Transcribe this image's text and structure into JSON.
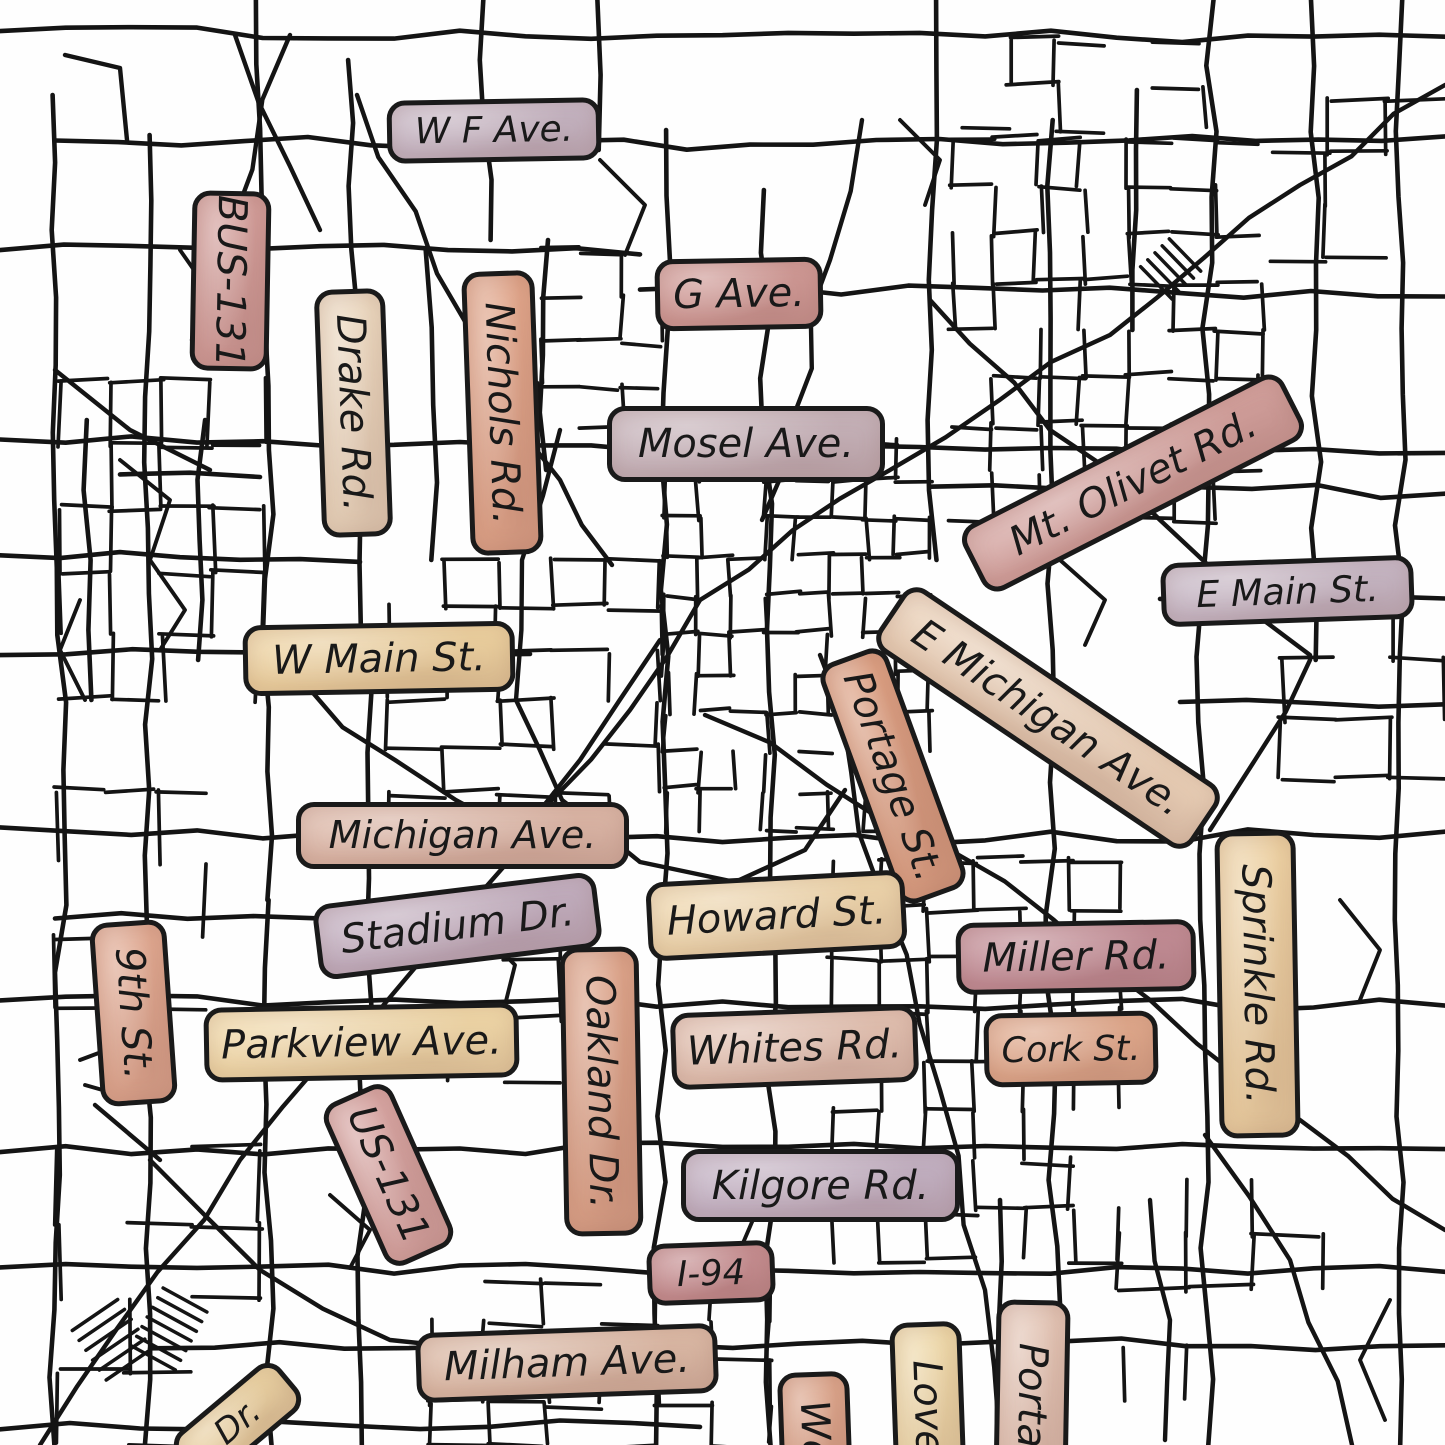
{
  "canvas": {
    "width": 1445,
    "height": 1445,
    "background_color": "#ffffff",
    "road_color": "#141414"
  },
  "map": {
    "description": "Hand-drawn style city street map with watercolor street-name badges",
    "labels": [
      {
        "id": "wf-ave",
        "text": "W F Ave.",
        "x": 387,
        "y": 99,
        "w": 214,
        "h": 63,
        "rotate": -1,
        "orientation": "horizontal",
        "fill": "#c6b6c4"
      },
      {
        "id": "bus-131",
        "text": "BUS-131",
        "x": 191,
        "y": 191,
        "w": 79,
        "h": 180,
        "rotate": 1,
        "orientation": "vertical",
        "fill": "#d19c98"
      },
      {
        "id": "drake-rd",
        "text": "Drake Rd.",
        "x": 318,
        "y": 289,
        "w": 71,
        "h": 248,
        "rotate": -2,
        "orientation": "vertical",
        "fill": "#ead6bd"
      },
      {
        "id": "nichols-rd",
        "text": "Nichols Rd.",
        "x": 466,
        "y": 271,
        "w": 73,
        "h": 284,
        "rotate": -2,
        "orientation": "vertical",
        "fill": "#dfa489"
      },
      {
        "id": "g-ave",
        "text": "G Ave.",
        "x": 655,
        "y": 258,
        "w": 168,
        "h": 72,
        "rotate": -1,
        "orientation": "horizontal",
        "fill": "#d09a96"
      },
      {
        "id": "mosel-ave",
        "text": "Mosel Ave.",
        "x": 607,
        "y": 406,
        "w": 278,
        "h": 76,
        "rotate": 0,
        "orientation": "horizontal",
        "fill": "#c6b3ba"
      },
      {
        "id": "mt-olivet-rd",
        "text": "Mt. Olivet Rd.",
        "x": 953,
        "y": 446,
        "w": 360,
        "h": 74,
        "rotate": -27,
        "orientation": "horizontal",
        "fill": "#d2a09c"
      },
      {
        "id": "e-main-st",
        "text": "E Main St.",
        "x": 1161,
        "y": 559,
        "w": 253,
        "h": 64,
        "rotate": -2,
        "orientation": "horizontal",
        "fill": "#c7b8c6"
      },
      {
        "id": "e-michigan-ave",
        "text": "E Michigan Ave.",
        "x": 858,
        "y": 680,
        "w": 380,
        "h": 76,
        "rotate": 34,
        "orientation": "horizontal",
        "fill": "#e9cfb6"
      },
      {
        "id": "portage-st",
        "text": "Portage St.",
        "x": 857,
        "y": 648,
        "w": 72,
        "h": 256,
        "rotate": -20,
        "orientation": "vertical",
        "fill": "#db9f82"
      },
      {
        "id": "w-main-st",
        "text": "W Main St.",
        "x": 243,
        "y": 623,
        "w": 272,
        "h": 71,
        "rotate": -1,
        "orientation": "horizontal",
        "fill": "#edd2a0"
      },
      {
        "id": "michigan-ave",
        "text": "Michigan Ave.",
        "x": 296,
        "y": 802,
        "w": 333,
        "h": 67,
        "rotate": 0,
        "orientation": "horizontal",
        "fill": "#dcb7a7"
      },
      {
        "id": "stadium-dr",
        "text": "Stadium Dr.",
        "x": 315,
        "y": 888,
        "w": 285,
        "h": 76,
        "rotate": -7,
        "orientation": "horizontal",
        "fill": "#c2afc0"
      },
      {
        "id": "howard-st",
        "text": "Howard St.",
        "x": 647,
        "y": 876,
        "w": 259,
        "h": 79,
        "rotate": -3,
        "orientation": "horizontal",
        "fill": "#eed6ac"
      },
      {
        "id": "miller-rd",
        "text": "Miller Rd.",
        "x": 956,
        "y": 921,
        "w": 240,
        "h": 72,
        "rotate": -1,
        "orientation": "horizontal",
        "fill": "#c28d96"
      },
      {
        "id": "sprinkle-rd",
        "text": "Sprinkle Rd.",
        "x": 1217,
        "y": 831,
        "w": 81,
        "h": 307,
        "rotate": -1,
        "orientation": "vertical",
        "fill": "#ecd0a2"
      },
      {
        "id": "ninth-st",
        "text": "9th St.",
        "x": 95,
        "y": 921,
        "w": 77,
        "h": 184,
        "rotate": -4,
        "orientation": "vertical",
        "fill": "#dfa78f"
      },
      {
        "id": "parkview-ave",
        "text": "Parkview Ave.",
        "x": 204,
        "y": 1005,
        "w": 315,
        "h": 75,
        "rotate": -1,
        "orientation": "horizontal",
        "fill": "#f0d8a8"
      },
      {
        "id": "oakland-dr",
        "text": "Oakland Dr.",
        "x": 562,
        "y": 947,
        "w": 79,
        "h": 289,
        "rotate": -1,
        "orientation": "vertical",
        "fill": "#dba288"
      },
      {
        "id": "whites-rd",
        "text": "Whites Rd.",
        "x": 671,
        "y": 1009,
        "w": 247,
        "h": 77,
        "rotate": -2,
        "orientation": "horizontal",
        "fill": "#e2c1b1"
      },
      {
        "id": "cork-st",
        "text": "Cork St.",
        "x": 984,
        "y": 1012,
        "w": 174,
        "h": 74,
        "rotate": -1,
        "orientation": "horizontal",
        "fill": "#e0a98c"
      },
      {
        "id": "us-131",
        "text": "US-131",
        "x": 351,
        "y": 1086,
        "w": 75,
        "h": 178,
        "rotate": -24,
        "orientation": "vertical",
        "fill": "#d7a5a2"
      },
      {
        "id": "kilgore-rd",
        "text": "Kilgore Rd.",
        "x": 681,
        "y": 1149,
        "w": 279,
        "h": 73,
        "rotate": 0,
        "orientation": "horizontal",
        "fill": "#c3b2c4"
      },
      {
        "id": "i-94",
        "text": "I-94",
        "x": 647,
        "y": 1242,
        "w": 128,
        "h": 62,
        "rotate": -2,
        "orientation": "horizontal",
        "fill": "#c78f92"
      },
      {
        "id": "milham-ave",
        "text": "Milham Ave.",
        "x": 416,
        "y": 1328,
        "w": 302,
        "h": 70,
        "rotate": -2,
        "orientation": "horizontal",
        "fill": "#dcbaa6"
      },
      {
        "id": "dr-partial",
        "text": "Dr.",
        "x": 170,
        "y": 1392,
        "w": 135,
        "h": 60,
        "rotate": -40,
        "orientation": "horizontal",
        "fill": "#ecd4a4",
        "partial": true
      },
      {
        "id": "we-partial",
        "text": "We",
        "x": 779,
        "y": 1372,
        "w": 72,
        "h": 120,
        "rotate": -2,
        "orientation": "vertical",
        "fill": "#dca58b",
        "partial": true
      },
      {
        "id": "love-partial",
        "text": "Love",
        "x": 892,
        "y": 1322,
        "w": 72,
        "h": 170,
        "rotate": -2,
        "orientation": "vertical",
        "fill": "#eed8a8",
        "partial": true
      },
      {
        "id": "porta-partial",
        "text": "Porta",
        "x": 995,
        "y": 1300,
        "w": 74,
        "h": 190,
        "rotate": 1,
        "orientation": "vertical",
        "fill": "#e2c3b3",
        "partial": true
      }
    ]
  }
}
